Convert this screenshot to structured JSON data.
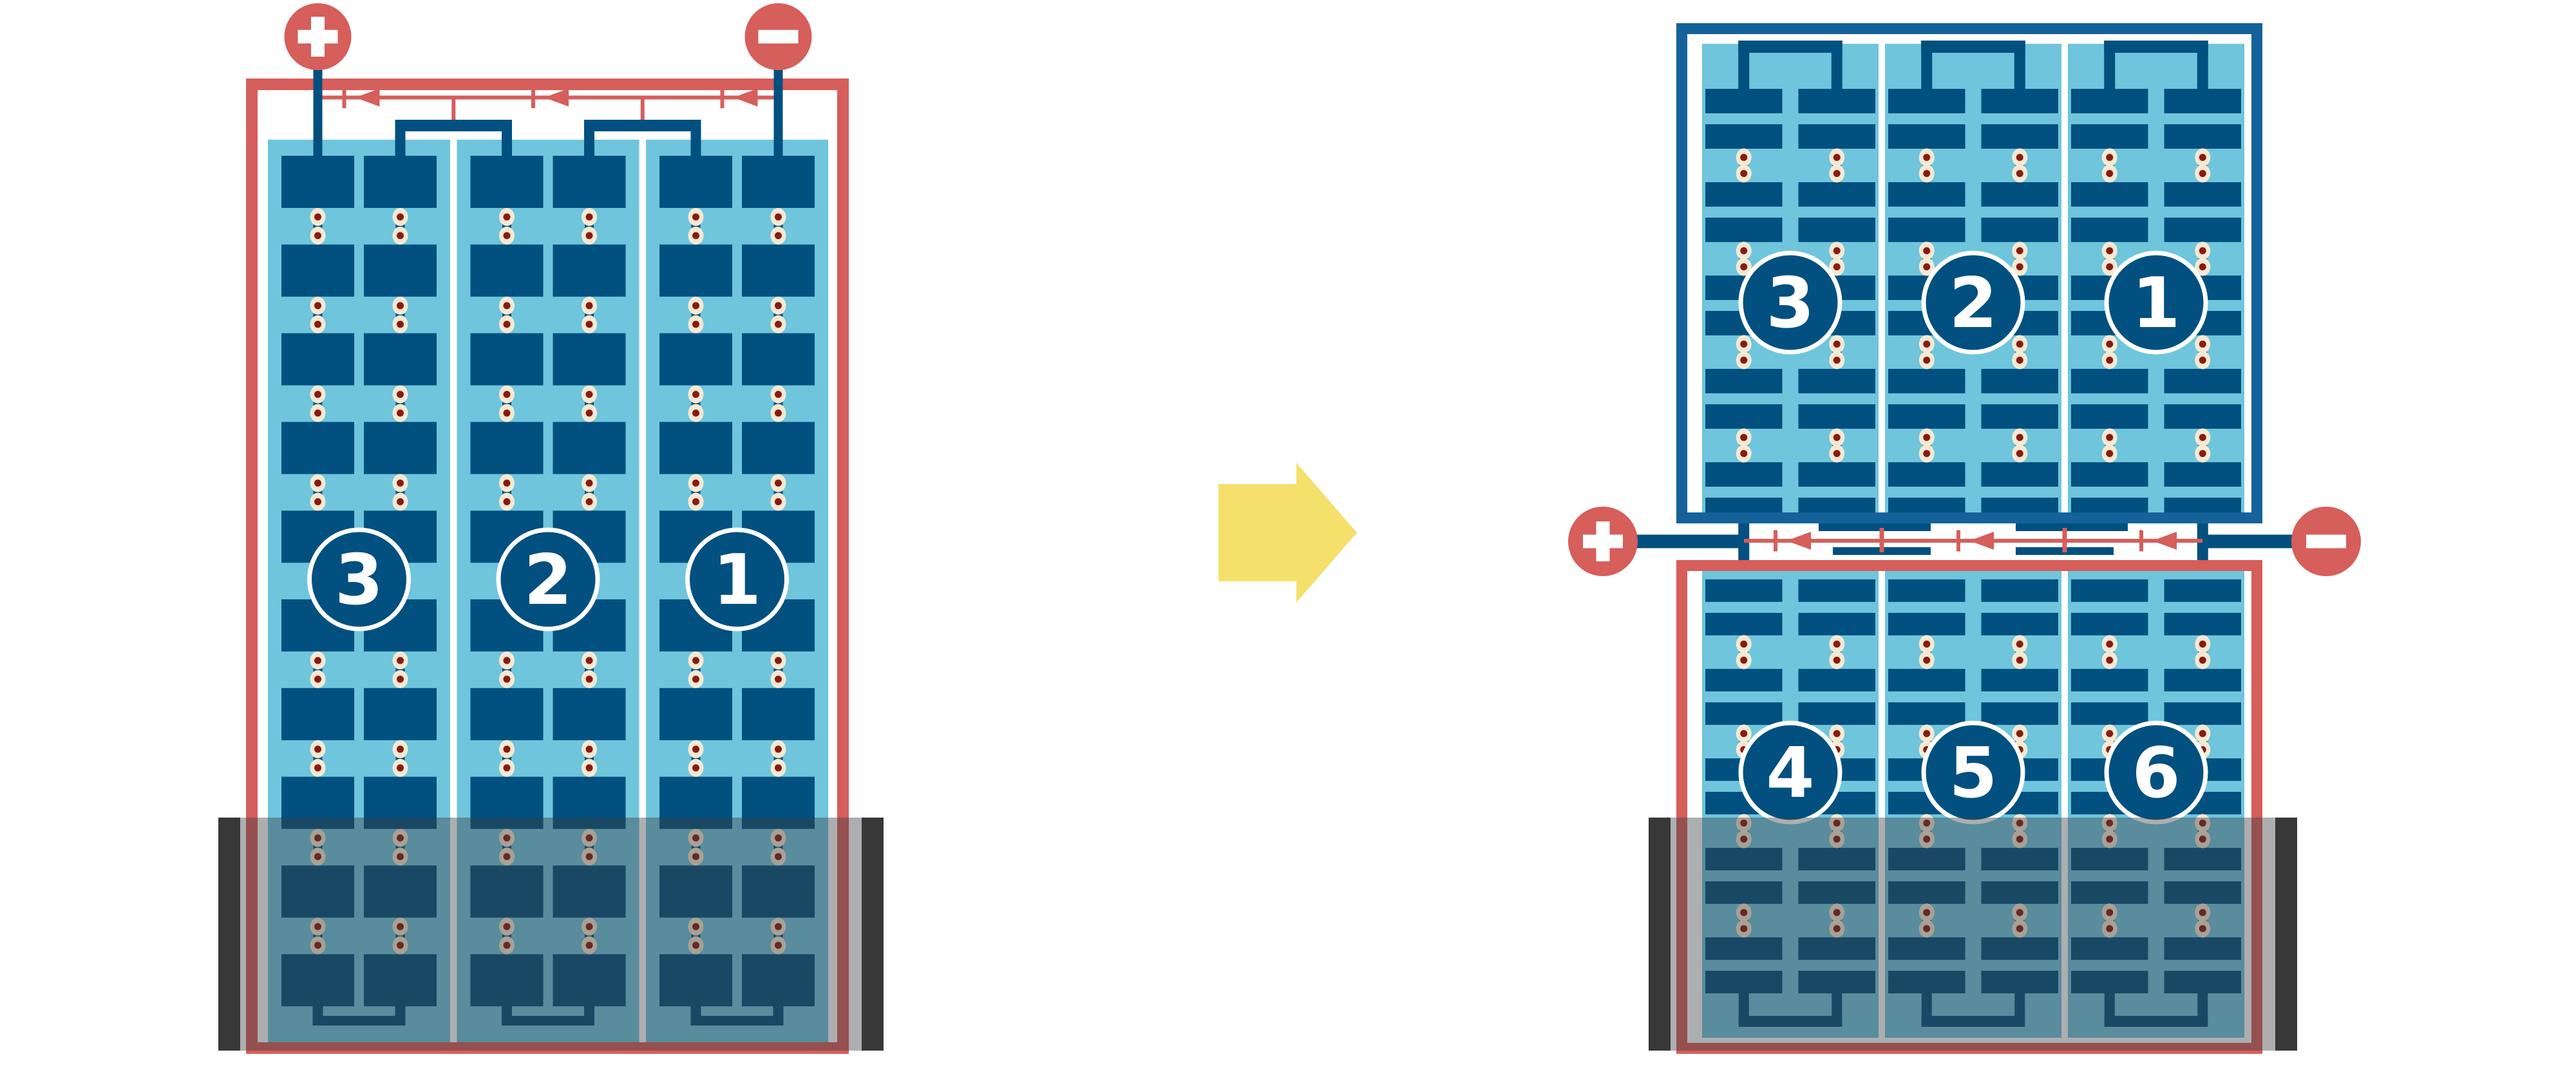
{
  "colors": {
    "red": "#D65E5B",
    "navy": "#01507F",
    "frame_blue": "#15629B",
    "cyan": "#6FC5DC",
    "cream": "#F4E9D3",
    "rivet_red": "#8A1A10",
    "yellow": "#F5E06C",
    "case_gray": "#3C3E42",
    "case_end_black": "#232323"
  },
  "left_battery": {
    "name": "three-cell battery, front view",
    "terminals": {
      "positive": "+",
      "negative": "−"
    },
    "cells": [
      {
        "label": "3"
      },
      {
        "label": "2"
      },
      {
        "label": "1"
      }
    ],
    "plate_rows": 10,
    "current_arrow_count": 3,
    "current_direction": "left"
  },
  "transform": {
    "arrow_icon": "yellow-right-arrow"
  },
  "right_battery": {
    "name": "six-cell battery, two rows joined at center terminals",
    "terminals": {
      "positive": "+",
      "negative": "−"
    },
    "top_row_cells": [
      {
        "label": "3"
      },
      {
        "label": "2"
      },
      {
        "label": "1"
      }
    ],
    "bottom_row_cells": [
      {
        "label": "4"
      },
      {
        "label": "5"
      },
      {
        "label": "6"
      }
    ],
    "top_plate_rows": 10,
    "bottom_plate_rows": 10,
    "current_arrow_count": 3,
    "current_direction": "left"
  }
}
